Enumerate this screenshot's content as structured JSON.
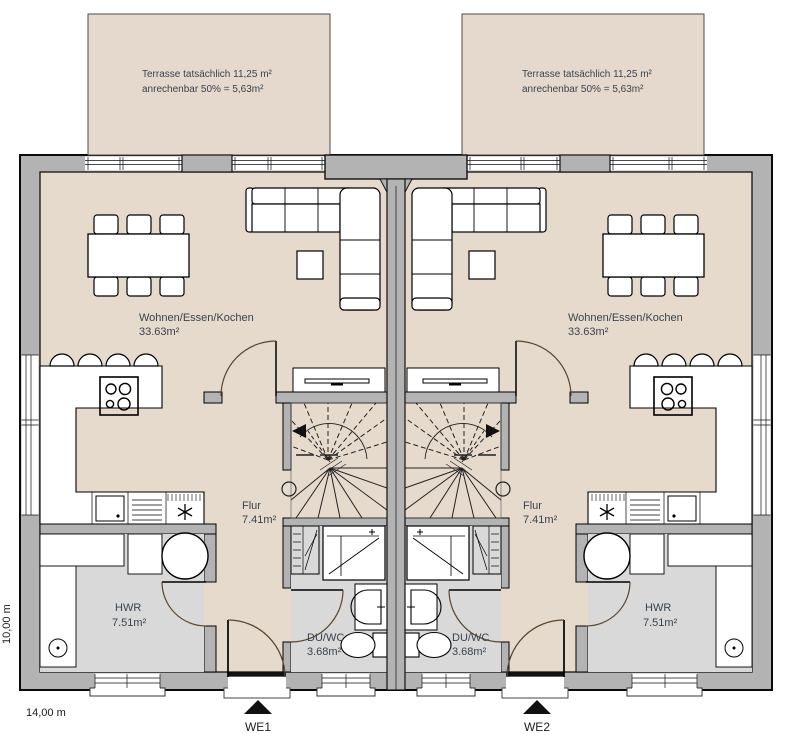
{
  "plan": {
    "units": [
      {
        "label": "WE1",
        "terrace": {
          "line1": "Terrasse tatsächlich 11,25 m²",
          "line2": "anrechenbar 50% = 5,63m²"
        },
        "rooms": {
          "living": {
            "name": "Wohnen/Essen/Kochen",
            "area": "33.63m²"
          },
          "hall": {
            "name": "Flur",
            "area": "7.41m²"
          },
          "utility": {
            "name": "HWR",
            "area": "7.51m²"
          },
          "bath": {
            "name": "DU/WC",
            "area": "3.68m²"
          }
        }
      },
      {
        "label": "WE2",
        "terrace": {
          "line1": "Terrasse tatsächlich 11,25 m²",
          "line2": "anrechenbar 50% = 5,63m²"
        },
        "rooms": {
          "living": {
            "name": "Wohnen/Essen/Kochen",
            "area": "33.63m²"
          },
          "hall": {
            "name": "Flur",
            "area": "7.41m²"
          },
          "utility": {
            "name": "HWR",
            "area": "7.51m²"
          },
          "bath": {
            "name": "DU/WC",
            "area": "3.68m²"
          }
        }
      }
    ],
    "dimensions": {
      "width": "14,00 m",
      "depth": "10,00 m"
    },
    "colors": {
      "floor": "#e6dacc",
      "terrace": "#e4d9cc",
      "wall": "#b3b3b3",
      "wet_room_floor": "#d9d9d9",
      "door_swing": "#5a452f",
      "label_text": "#39434e"
    }
  }
}
